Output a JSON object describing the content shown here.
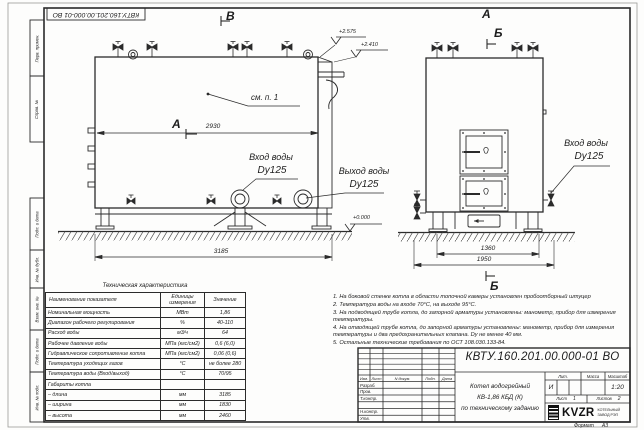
{
  "sheet": {
    "designation_top": "КВТУ.160.201.00.000-01 ВО",
    "format_label": "Формат",
    "format_value": "А3"
  },
  "margin_labels": [
    "Перв. примен.",
    "Справ. №",
    "Подп. и дата",
    "Инв. № дубл.",
    "Взам. инв. №",
    "Подп. и дата",
    "Инв. № подл."
  ],
  "side_view": {
    "view_letter": "В",
    "cut_letter": "А",
    "see_note": "см. п. 1",
    "dim_top": "2930",
    "dim_length": "3185",
    "elev_top": "+2.575",
    "elev_mid": "+2.410",
    "elev_zero": "+0.000",
    "inlet_line1": "Вход воды",
    "inlet_line2": "Dy125",
    "outlet_line1": "Выход воды",
    "outlet_line2": "Dy125"
  },
  "front_view": {
    "view_letter": "А",
    "cut_letter_top": "Б",
    "cut_letter_bottom": "Б",
    "dim_inner": "1360",
    "dim_outer": "1950",
    "inlet_line1": "Вход воды",
    "inlet_line2": "Dy125"
  },
  "spec_table": {
    "title": "Техническая характеристика",
    "col_name": "Наименование показателя",
    "col_units": "Единицы измерения",
    "col_value": "Значение",
    "rows": [
      {
        "name": "Номинальная мощность",
        "units": "МВт",
        "value": "1,86"
      },
      {
        "name": "Диапазон рабочего регулирования",
        "units": "%",
        "value": "40-110"
      },
      {
        "name": "Расход воды",
        "units": "м3/ч",
        "value": "64"
      },
      {
        "name": "Рабочее давление воды",
        "units": "МПа (кгс/см2)",
        "value": "0,6 (6,0)"
      },
      {
        "name": "Гидравлическое сопротивление котла",
        "units": "МПа (кгс/см2)",
        "value": "0,06 (0,6)"
      },
      {
        "name": "Температура уходящих газов",
        "units": "°С",
        "value": "не более 280"
      },
      {
        "name": "Температура воды (Вход/выход)",
        "units": "°С",
        "value": "70/95"
      },
      {
        "name": "Габариты котла",
        "units": "",
        "value": ""
      },
      {
        "name": "– длина",
        "units": "мм",
        "value": "3185"
      },
      {
        "name": "– ширина",
        "units": "мм",
        "value": "1830"
      },
      {
        "name": "– высота",
        "units": "мм",
        "value": "2460"
      }
    ]
  },
  "notes": [
    "1.  На боковой стенке котла в области топочной камеры установлен пробоотборный штуцер",
    "2.  Температура воды на входе 70°С, на выходе 95°С.",
    "3.  На подводящей трубе котла, до запорной арматуры установлены: манометр, прибор для измерения температуры.",
    "4.  На отводящей трубе котла, до запорной арматуры установлены: манометр, прибор для измерения температуры и два предохранительных клапана. Dу не менее 40 мм.",
    "5.  Остальные технические требования по ОСТ 108.030.133-84."
  ],
  "title_block": {
    "designation": "КВТУ.160.201.00.000-01 ВО",
    "product_line1": "Котел водогрейный",
    "product_line2": "КВ-1,86 КБД (К)",
    "product_line3": "по техническому заданию",
    "col_izm": "Изм.",
    "col_list": "Лист",
    "col_doc": "N докум.",
    "col_sign": "Подп.",
    "col_date": "Дата",
    "row_labels": [
      "Разраб.",
      "Пров.",
      "Т.контр.",
      "Н.контр.",
      "Утв."
    ],
    "lit_label": "Лит.",
    "lit_value": "И",
    "mass_label": "Масса",
    "scale_label": "Масштаб",
    "scale_value": "1:20",
    "sheet_label": "Лист",
    "sheet_value": "1",
    "sheets_label": "Листов",
    "sheets_value": "2",
    "logo_text": "KVZR",
    "logo_sub1": "КОТЕЛЬНЫЙ",
    "logo_sub2": "ЗАВОД РЭП"
  }
}
